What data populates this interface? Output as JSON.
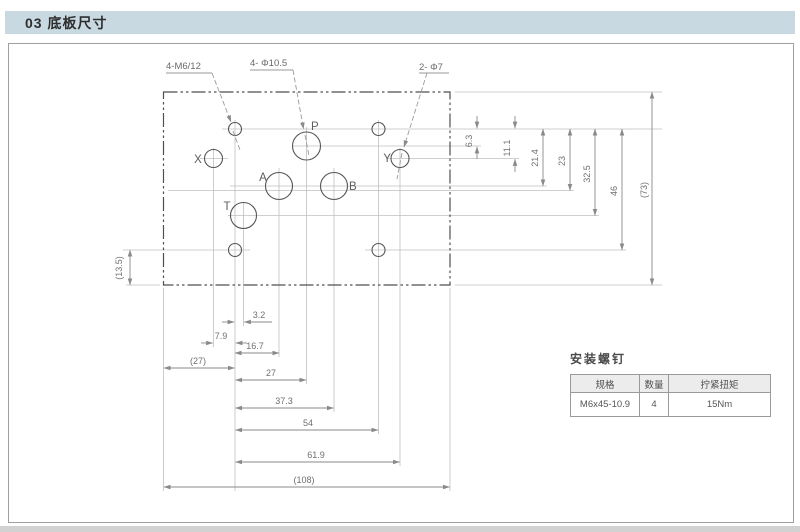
{
  "page": {
    "title_bar": "03 底板尺寸"
  },
  "drawing": {
    "leader_labels": {
      "mounting_holes": "4-M6/12",
      "main_ports": "4- Φ10.5",
      "pilot_ports": "2- Φ7"
    },
    "port_labels": {
      "x": "X",
      "p": "P",
      "y": "Y",
      "a": "A",
      "b": "B",
      "t": "T"
    },
    "dims": {
      "right_vertical": [
        "6.3",
        "11.1",
        "21.4",
        "23",
        "32.5",
        "46",
        "(73)"
      ],
      "bottom_horizontal": [
        "3.2",
        "7.9",
        "16.7",
        "(27)",
        "27",
        "37.3",
        "54",
        "61.9",
        "(108)"
      ],
      "left_vertical": [
        "(13.5)"
      ]
    }
  },
  "table": {
    "title": "安装螺钉",
    "headers": [
      "规格",
      "数量",
      "拧紧扭矩"
    ],
    "rows": [
      [
        "M6x45-10.9",
        "4",
        "15Nm"
      ]
    ]
  },
  "colors": {
    "banner_bg": "#c8d9e2",
    "outline_line": "#4f4f4f",
    "dim_line": "#8a8a8a",
    "extension_line": "#bfbfbf",
    "table_header_bg": "#ececec"
  }
}
